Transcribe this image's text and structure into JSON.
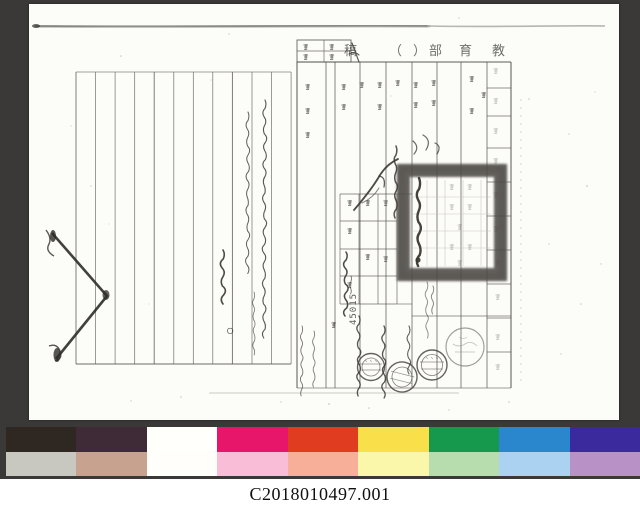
{
  "scan": {
    "background_color": "#3a3937",
    "page_color": "#fcfcf9"
  },
  "document": {
    "header": {
      "title_rtl": "教育部（　）稿",
      "glyphs": [
        "稿",
        "（",
        "）",
        "部",
        "育",
        "教"
      ]
    },
    "stamps": {
      "number_stamp": "45015"
    },
    "marks": {
      "circle_mark": "○"
    }
  },
  "footer": {
    "catalog_number": "C2018010497.001"
  },
  "color_bar": {
    "top": [
      "#2f2822",
      "#3e2b37",
      "#fffffc",
      "#e7166a",
      "#e03c1f",
      "#f9e04a",
      "#16994d",
      "#2a87ce",
      "#3b2a9e"
    ],
    "bottom": [
      "#c9c8c0",
      "#c7a28e",
      "#fffefb",
      "#f9bdd7",
      "#f7af99",
      "#faf7ab",
      "#b7dcae",
      "#abd3f1",
      "#b892c7"
    ]
  }
}
